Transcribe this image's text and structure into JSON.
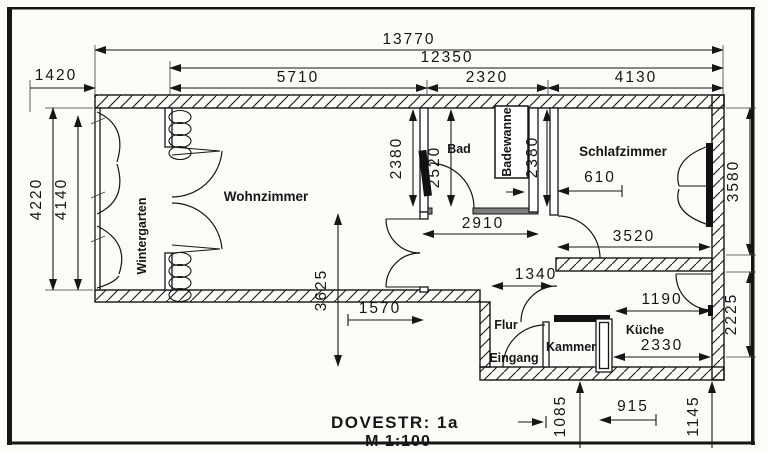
{
  "footer": {
    "address": "DOVESTR: 1a",
    "scale": "M 1:100"
  },
  "rooms": {
    "wintergarten": "Wintergarten",
    "wohnzimmer": "Wohnzimmer",
    "bad": "Bad",
    "badewanne": "Badewanne",
    "schlafzimmer": "Schlafzimmer",
    "flur": "Flur",
    "eingang": "Eingang",
    "kammer": "Kammer",
    "kueche": "Küche"
  },
  "dims": {
    "overall_width": "13770",
    "main_width": "12350",
    "wohnzimmer_top": "5710",
    "bad_top": "2320",
    "schlafzimmer_top": "4130",
    "wintergarten_width": "1420",
    "left_outer_depth": "4220",
    "left_inner_depth": "4140",
    "wohnzimmer_right_depth": "2380",
    "bad_depth": "2520",
    "badewanne_depth": "2380",
    "schlafzimmer_depth": "3580",
    "kueche_right_depth": "2225",
    "flur_top_width": "2910",
    "schlafzimmer_bottom_width": "3520",
    "schlafzimmer_door_offset": "610",
    "flur_total_depth": "3625",
    "wohnzimmer_bottom_offset": "1570",
    "flur_bottom_width": "1340",
    "kueche_top_width": "1190",
    "kueche_bottom_width": "2330",
    "kammer_bottom_width": "1085",
    "kammer_kueche_offset": "915",
    "kueche_offset": "1145"
  },
  "colors": {
    "ink": "#161616",
    "paper": "#fcfbf8",
    "dark_bar": "#222222"
  }
}
